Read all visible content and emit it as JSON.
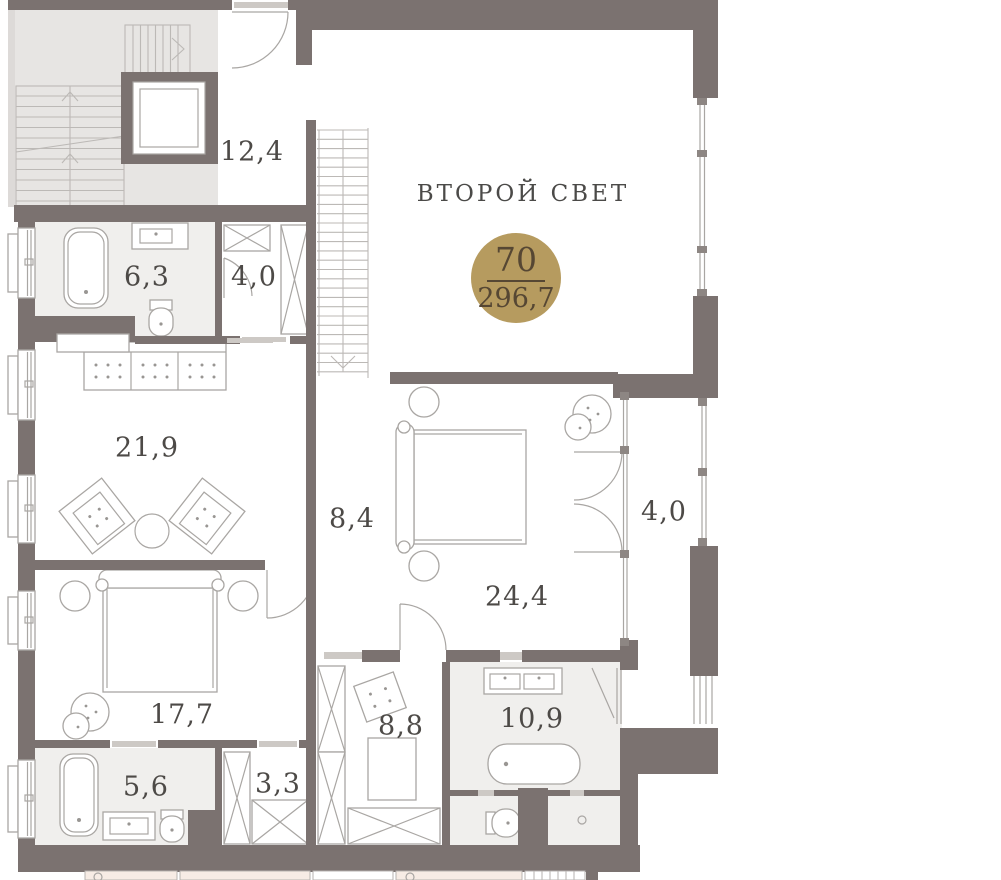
{
  "floor_plan": {
    "double_height_label": "ВТОРОЙ СВЕТ",
    "unit_badge": {
      "number": "70",
      "area": "296,7"
    },
    "room_areas": {
      "entry_hall": "12,4",
      "bathroom_top": "6,3",
      "wardrobe_top": "4,0",
      "living_room": "21,9",
      "corridor": "8,4",
      "master_bedroom": "24,4",
      "balcony": "4,0",
      "bedroom_2": "17,7",
      "dressing_room": "8,8",
      "master_bathroom": "10,9",
      "bathroom_bottom": "5,6",
      "wardrobe_bottom": "3,3"
    },
    "colors": {
      "walls": "#7b7270",
      "common_area": "#e7e5e3",
      "wet_room_fill": "#f0efed",
      "badge_gold": "#b69b5f",
      "badge_text": "#564733",
      "label_text": "#4d4a47",
      "furniture_line": "#a9a6a3",
      "neighbor_tint": "#f7ece5"
    }
  }
}
